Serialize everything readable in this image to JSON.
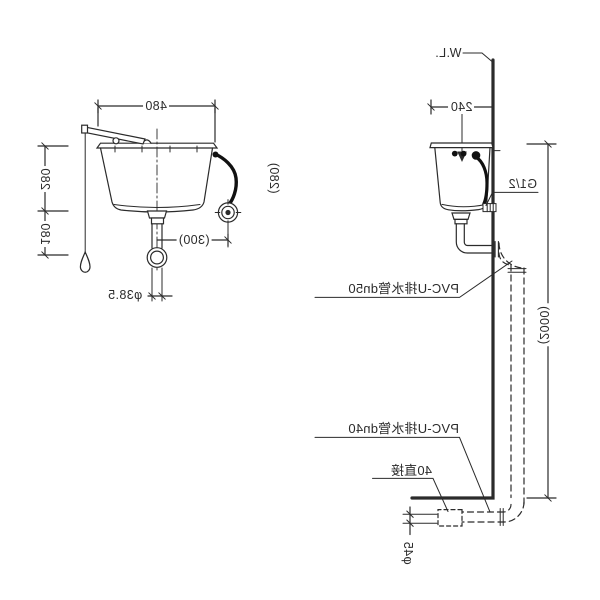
{
  "front_view": {
    "dim_width": "480",
    "dim_upper_height": "280",
    "dim_lower_height": "180",
    "dim_side_height": "(280)",
    "dim_inlet_offset": "(300)",
    "dim_outlet_dia": "φ38.5"
  },
  "side_view": {
    "water_line": "W.L.",
    "dim_depth": "240",
    "inlet_connection": "G1/2",
    "dim_install_height": "(2000)",
    "drain_pipe_dn50": "PVC-U排水管dn50",
    "drain_pipe_dn40": "PVC-U排水管dn40",
    "coupling": "40直接",
    "dim_coupling_dia": "φ45"
  },
  "style": {
    "line_color": "#2b2b2b",
    "hose_color": "#111111",
    "background": "#ffffff"
  }
}
